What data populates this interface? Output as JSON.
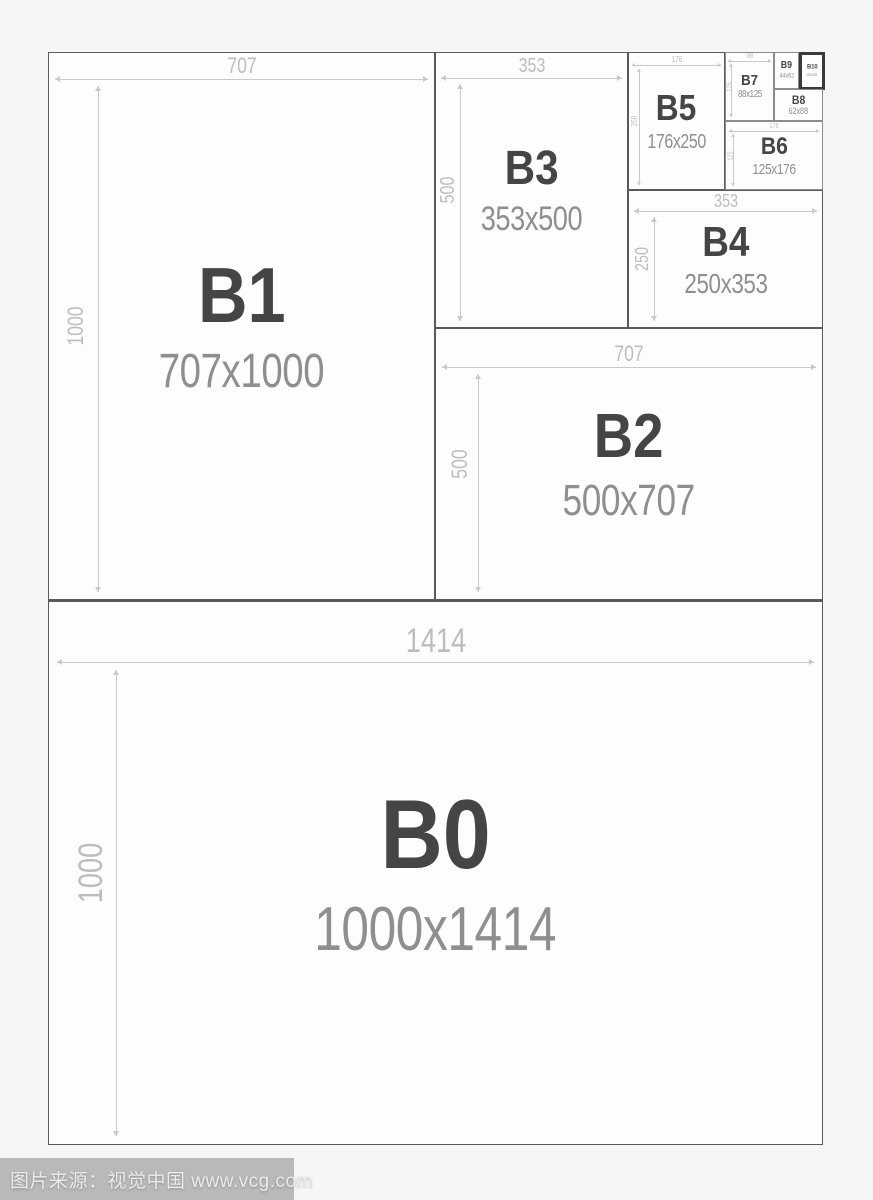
{
  "boxes": [
    {
      "name": "B0",
      "size": "1000x1414",
      "width_dim": "1414",
      "height_dim": "1000"
    },
    {
      "name": "B1",
      "size": "707x1000",
      "width_dim": "707",
      "height_dim": "1000"
    },
    {
      "name": "B2",
      "size": "500x707",
      "width_dim": "707",
      "height_dim": "500"
    },
    {
      "name": "B3",
      "size": "353x500",
      "width_dim": "353",
      "height_dim": "500"
    },
    {
      "name": "B4",
      "size": "250x353",
      "width_dim": "353",
      "height_dim": "250"
    },
    {
      "name": "B5",
      "size": "176x250",
      "width_dim": "176",
      "height_dim": "250"
    },
    {
      "name": "B6",
      "size": "125x176",
      "width_dim": "176",
      "height_dim": "125"
    },
    {
      "name": "B7",
      "size": "88x125",
      "width_dim": "88",
      "height_dim": "125"
    },
    {
      "name": "B8",
      "size": "62x88"
    },
    {
      "name": "B9",
      "size": "44x62"
    },
    {
      "name": "B10",
      "size": "31x44",
      "highlighted": true
    }
  ],
  "watermark": {
    "text": "图片来源：视觉中国 www.vcg.com"
  },
  "colors": {
    "background": "#f6f6f6",
    "box_fill": "#fdfdfd",
    "box_border": "#5a5a5a",
    "highlight_border": "#3a3a3a",
    "name_text": "#454545",
    "size_text": "#8f8f8f",
    "dimension": "#c9c9c9",
    "watermark_bar": "#b9b9b9"
  }
}
